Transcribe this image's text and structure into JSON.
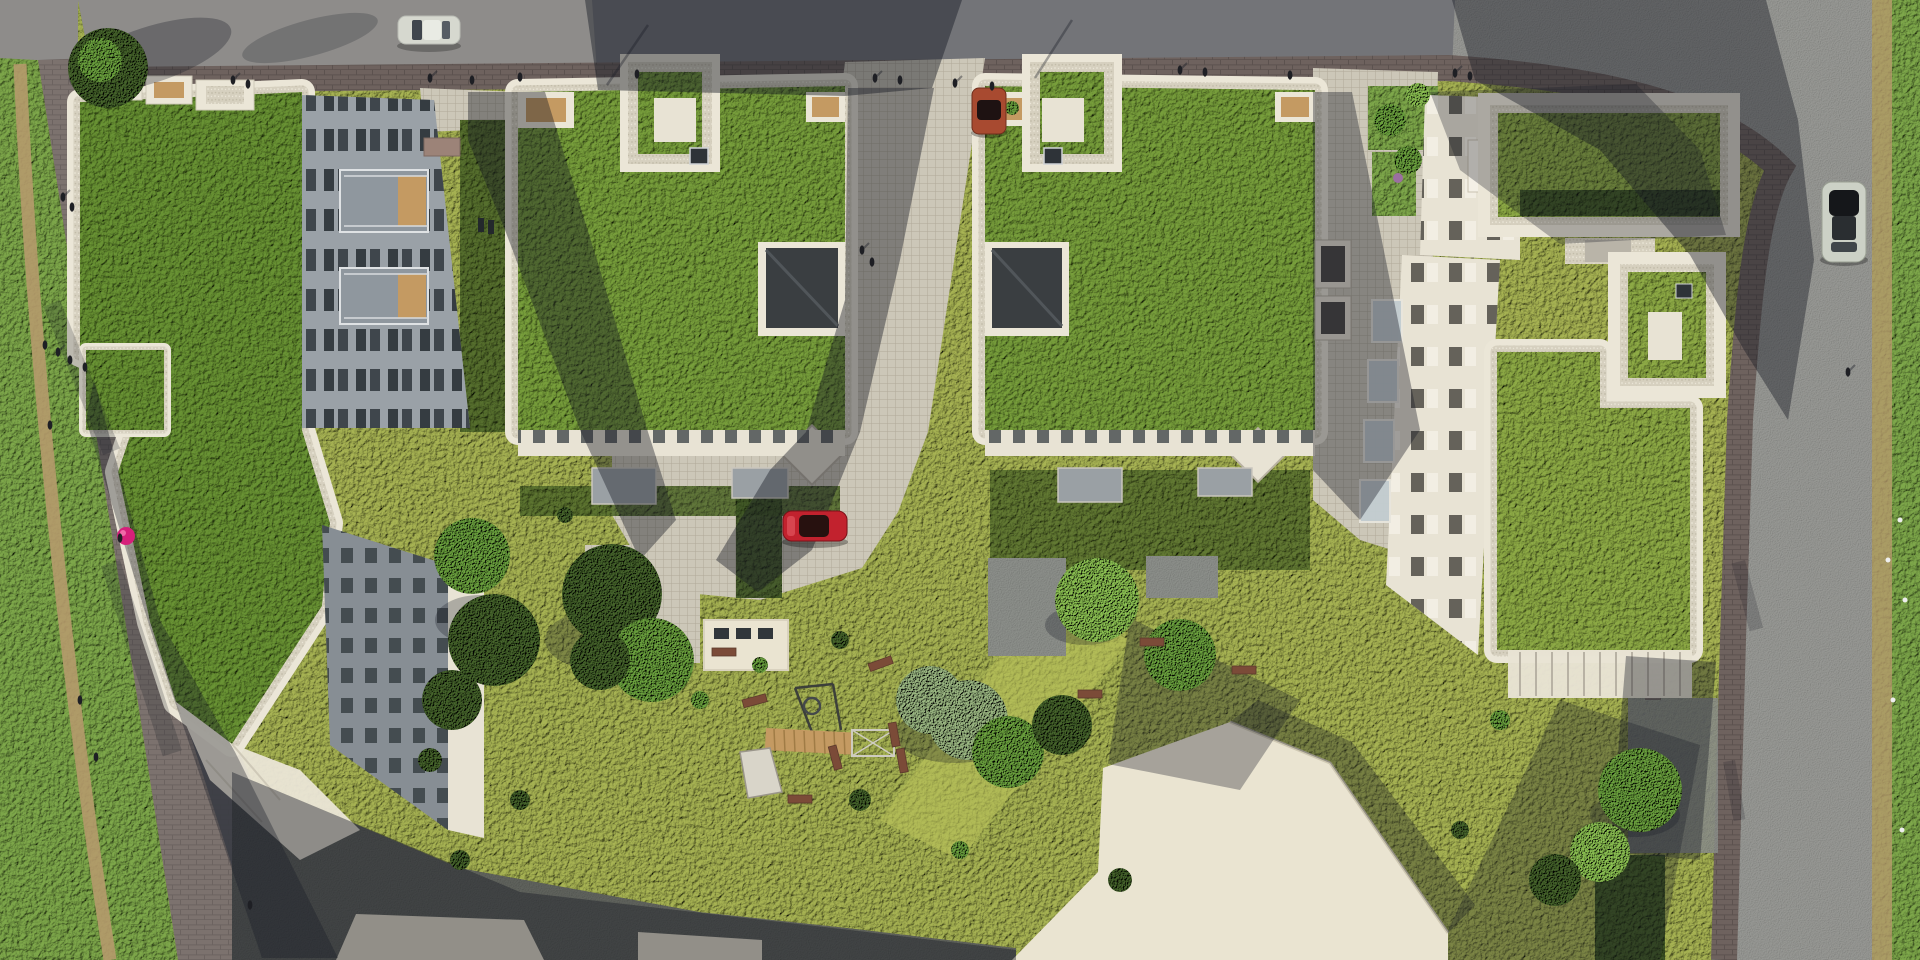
{
  "scene": {
    "type": "aerial-architectural-rendering",
    "view": "top-down bird's eye",
    "subject": "Residential block with five green-roof apartment buildings, landscaped inner courtyard with playground, surrounding streets and sidewalks"
  },
  "colors": {
    "asphaltMid": "#737478",
    "asphaltLight": "#8e8c8a",
    "asphaltDark": "#515256",
    "roadLight": "#9a9b97",
    "sidewalkBrick": "#6e625e",
    "brickLine": "#5c524f",
    "plaza": "#ccc7b8",
    "plazaLine": "#b2ac9c",
    "gravel": "#d6d0bf",
    "gravelDot1": "#c2bca9",
    "gravelDot2": "#eae5d6",
    "parapet": "#ebe6d7",
    "facadeSun": "#e8e3d4",
    "facadeShade": "#9aa1a7",
    "facadeShade2": "#878e94",
    "winDark": "#30373c",
    "winShade": "#4e4b45",
    "roofGreen": "#79a03c",
    "roofGreenD": "#6a9434",
    "roofGreenY": "#8fac46",
    "lawnBright": "#a9b554",
    "lawnMid": "#7fa94b",
    "lawnDark": "#57702e",
    "hedge": "#415926",
    "treeBright": "#8dc253",
    "treeMid": "#6ca23f",
    "treeDark": "#46642c",
    "treeSage": "#9cb883",
    "dirt": "#b59a6b",
    "stoneMid": "#8f928d",
    "stoneDark": "#62655f",
    "shadow": "#171a24",
    "wood": "#c49a62",
    "bench": "#7b4b38",
    "umbrella": "#d61f7a",
    "shedCream": "#eae4d1"
  },
  "objects": {
    "buildings": [
      {
        "id": "building-west",
        "roof": "extensive green roof",
        "features": [
          "slanted footprint along west sidewalk",
          "east facade with balconies",
          "small green-roof annex",
          "south sloped roof wing with skylights",
          "rooftop terraces on north edge"
        ]
      },
      {
        "id": "building-north-a",
        "roof": "extensive green roof",
        "features": [
          "raised rooftop terrace court with skylight",
          "corner notch terraces",
          "dark pitched roof structure on east edge",
          "diamond corner skylight",
          "south entry canopies"
        ]
      },
      {
        "id": "building-north-b",
        "roof": "extensive green roof",
        "features": [
          "raised rooftop terrace court with skylight",
          "corner notch terraces",
          "dark pitched roof structure on west edge",
          "diamond corner skylight",
          "south entry canopies"
        ]
      },
      {
        "id": "building-east-complex",
        "roof": "extensive green roofs with hedge rows",
        "features": [
          "long west facade with glass balconies",
          "square roof pavilion",
          "north roof terrace",
          "south pergola terrace band"
        ]
      },
      {
        "id": "buildings-south",
        "roof": "plain light flat roofs",
        "features": [
          "partially visible at bottom edge"
        ]
      }
    ],
    "vehicles": [
      {
        "id": "car-north-street",
        "color": "#d6d8cf",
        "description": "white car driving on the north street"
      },
      {
        "id": "car-courtyard",
        "color": "#c2222e",
        "description": "red car parked on the courtyard paving"
      },
      {
        "id": "car-north-kerb",
        "color": "#a84a30",
        "description": "dark orange car parked at the north kerb"
      },
      {
        "id": "car-east-street",
        "color": "#ccd1c6",
        "roof_color": "#17191c",
        "description": "white car with black roof parked on the east street"
      }
    ],
    "playground": {
      "equipment": [
        "swing-set",
        "climbing-frame",
        "wooden-bridge",
        "spiral-pole",
        "benches"
      ]
    },
    "people": {
      "approx_count": 24,
      "locations": [
        "north sidewalk",
        "west sidewalk",
        "central walkway",
        "east kerb"
      ]
    },
    "vegetation": {
      "green_roofs": 5,
      "street_trees": true,
      "courtyard_trees": true,
      "hedges": true,
      "lawns": true,
      "flower_patches": true
    },
    "ground": {
      "surfaces": [
        "dark asphalt street",
        "brick sidewalks",
        "grid-paved walkways",
        "gravel roof borders",
        "stone patios",
        "lawns",
        "dirt paths"
      ]
    }
  }
}
